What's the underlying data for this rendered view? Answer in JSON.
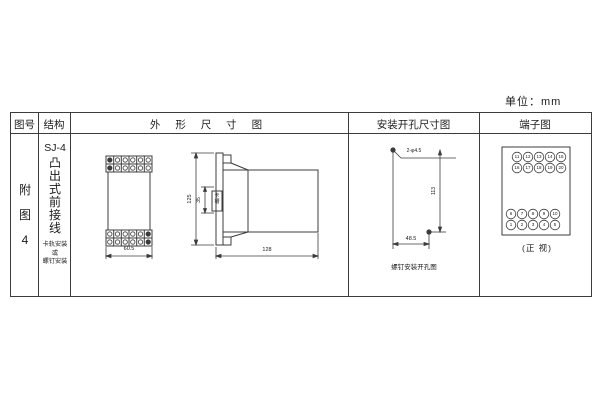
{
  "sheet": {
    "unit_label": "单位：mm",
    "colors": {
      "line": "#3c3c3c",
      "text": "#1a1a1a",
      "background": "#ffffff"
    }
  },
  "table": {
    "headers": {
      "figure_no": "图号",
      "structure": "结构",
      "outline": "外 形 尺 寸 图",
      "mounting": "安装开孔尺寸图",
      "terminal": "端子图"
    }
  },
  "figure": {
    "label_vertical": "附图4"
  },
  "structure": {
    "model": "SJ-4",
    "type_vertical": "凸出式前接线",
    "mounting_lines": [
      "卡轨安装",
      "或",
      "螺钉安装"
    ]
  },
  "outline_view": {
    "front_width": "60.5",
    "height": "125",
    "slot_height": "35",
    "slot_label": "卡槽",
    "depth": "128"
  },
  "mounting_view": {
    "holes_label": "2-φ4.5",
    "vertical_distance": "113",
    "horizontal_distance": "48.5",
    "caption": "螺钉安装开孔图"
  },
  "terminal_diagram": {
    "rows": [
      {
        "values": [
          "11",
          "12",
          "13",
          "14",
          "15"
        ]
      },
      {
        "values": [
          "16",
          "17",
          "18",
          "19",
          "20"
        ]
      },
      {
        "values": [
          "6",
          "7",
          "8",
          "9",
          "10"
        ]
      },
      {
        "values": [
          "1",
          "2",
          "3",
          "4",
          "5"
        ]
      }
    ],
    "caption": "(正 视)"
  }
}
